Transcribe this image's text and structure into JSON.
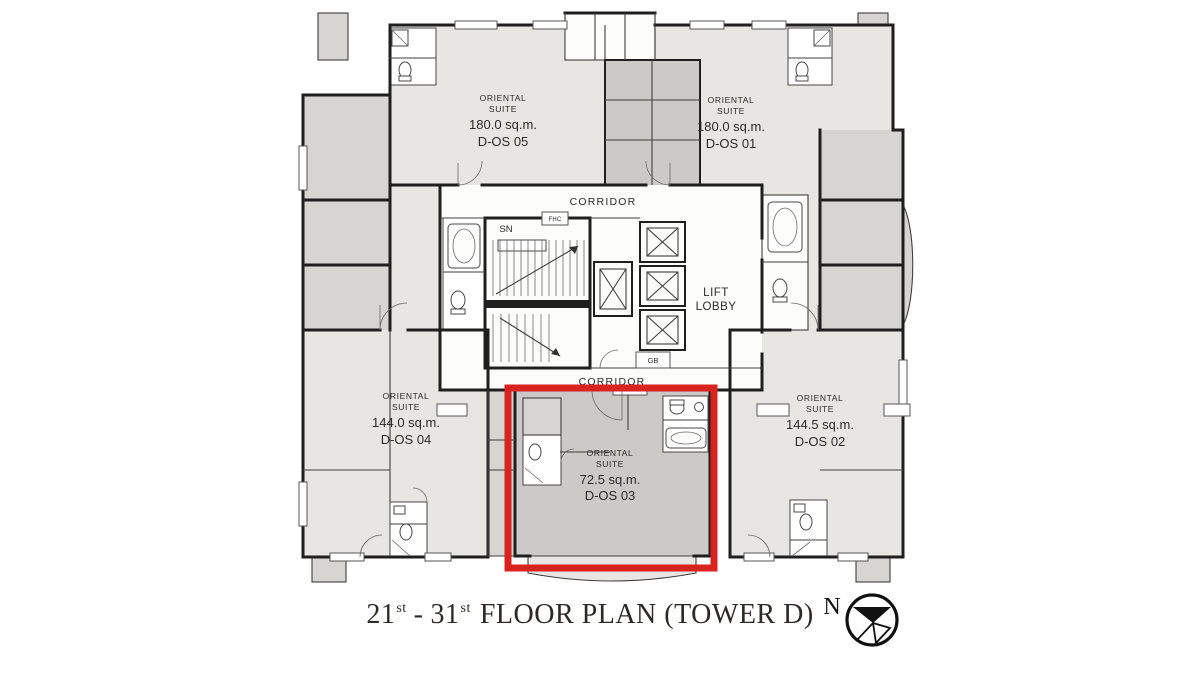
{
  "plan": {
    "units": [
      {
        "code": "D-OS 05",
        "lines": [
          "ORIENTAL",
          "SUITE",
          "180.0 sq.m.",
          "D-OS 05"
        ]
      },
      {
        "code": "D-OS 01",
        "lines": [
          "ORIENTAL",
          "SUITE",
          "180.0 sq.m.",
          "D-OS 01"
        ]
      },
      {
        "code": "D-OS 04",
        "lines": [
          "ORIENTAL",
          "SUITE",
          "144.0 sq.m.",
          "D-OS 04"
        ]
      },
      {
        "code": "D-OS 02",
        "lines": [
          "ORIENTAL",
          "SUITE",
          "144.5 sq.m.",
          "D-OS 02"
        ]
      },
      {
        "code": "D-OS 03",
        "lines": [
          "ORIENTAL",
          "SUITE",
          "72.5 sq.m.",
          "D-OS 03"
        ]
      }
    ],
    "core_labels": {
      "corridor_top": "CORRIDOR",
      "corridor_bottom": "CORRIDOR",
      "lift_lobby_line1": "LIFT",
      "lift_lobby_line2": "LOBBY",
      "sn": "SN",
      "fhc": "FHC",
      "gb": "GB"
    },
    "highlighted_unit": "D-OS 03"
  },
  "title": {
    "from_floor": "21",
    "from_sup": "st",
    "separator": "-",
    "to_floor": "31",
    "to_sup": "st",
    "rest": "FLOOR PLAN (TOWER D)"
  },
  "compass": {
    "north_label": "N"
  },
  "colors": {
    "highlight": "#d8231f",
    "unit_light": "#e7e6e3",
    "unit_medium": "#d6d5d2",
    "unit_dark": "#cbcac7",
    "wall": "#1f1f1f",
    "floor_white": "#fcfcfa",
    "title_text": "#2d2a26"
  }
}
